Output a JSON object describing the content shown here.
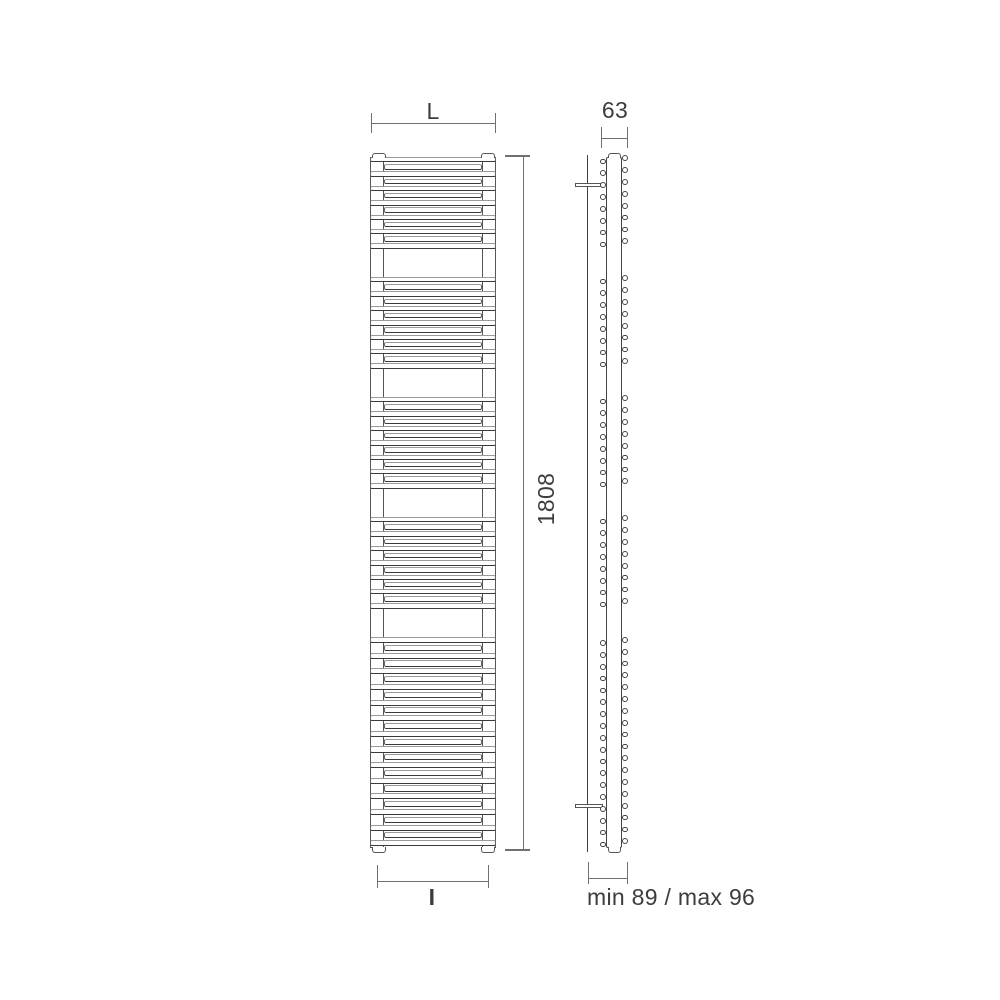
{
  "diagram": {
    "title": "towel radiator dimension drawing",
    "dimensions": {
      "width_label": "L",
      "interaxis_label": "I",
      "height_label": "1808",
      "depth_label": "63",
      "wall_distance_label": "min 89 / max 96"
    },
    "front_view": {
      "tube_groups": [
        {
          "tubes": 13
        },
        {
          "tubes": 13
        },
        {
          "tubes": 13
        },
        {
          "tubes": 13
        },
        {
          "tubes": 27
        }
      ],
      "collector_count": 2
    },
    "side_view": {
      "circle_groups": [
        {
          "circles_per_side": 8
        },
        {
          "circles_per_side": 8
        },
        {
          "circles_per_side": 8
        },
        {
          "circles_per_side": 8
        },
        {
          "circles_per_side": 18
        }
      ],
      "bracket_count": 2
    },
    "colors": {
      "line_dark": "#3a3a3a",
      "line_mid": "#707070",
      "line_light": "#9a9a9a",
      "text": "#3d3d3d",
      "background": "#ffffff"
    }
  }
}
